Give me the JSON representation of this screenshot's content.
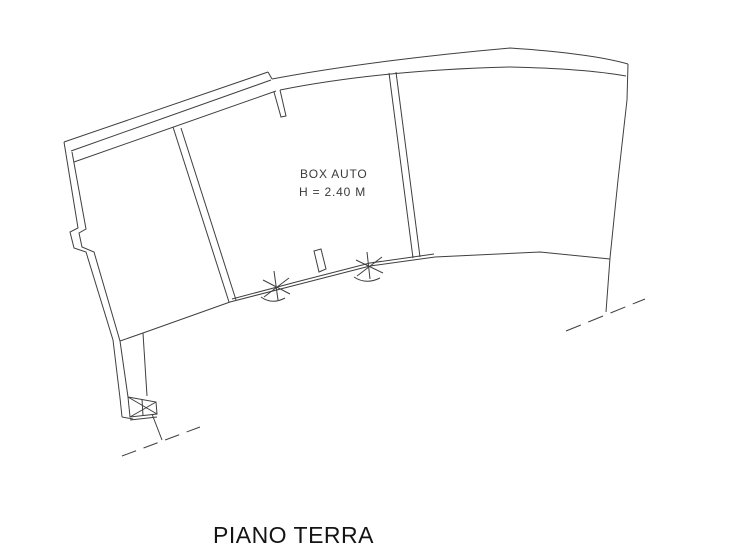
{
  "plan": {
    "title": "PIANO TERRA",
    "room_label": "BOX AUTO",
    "room_height": "H = 2.40 M"
  },
  "colors": {
    "line": "#3f3f3f",
    "text": "#3a3a3a",
    "title": "#141414",
    "background": "#ffffff"
  }
}
